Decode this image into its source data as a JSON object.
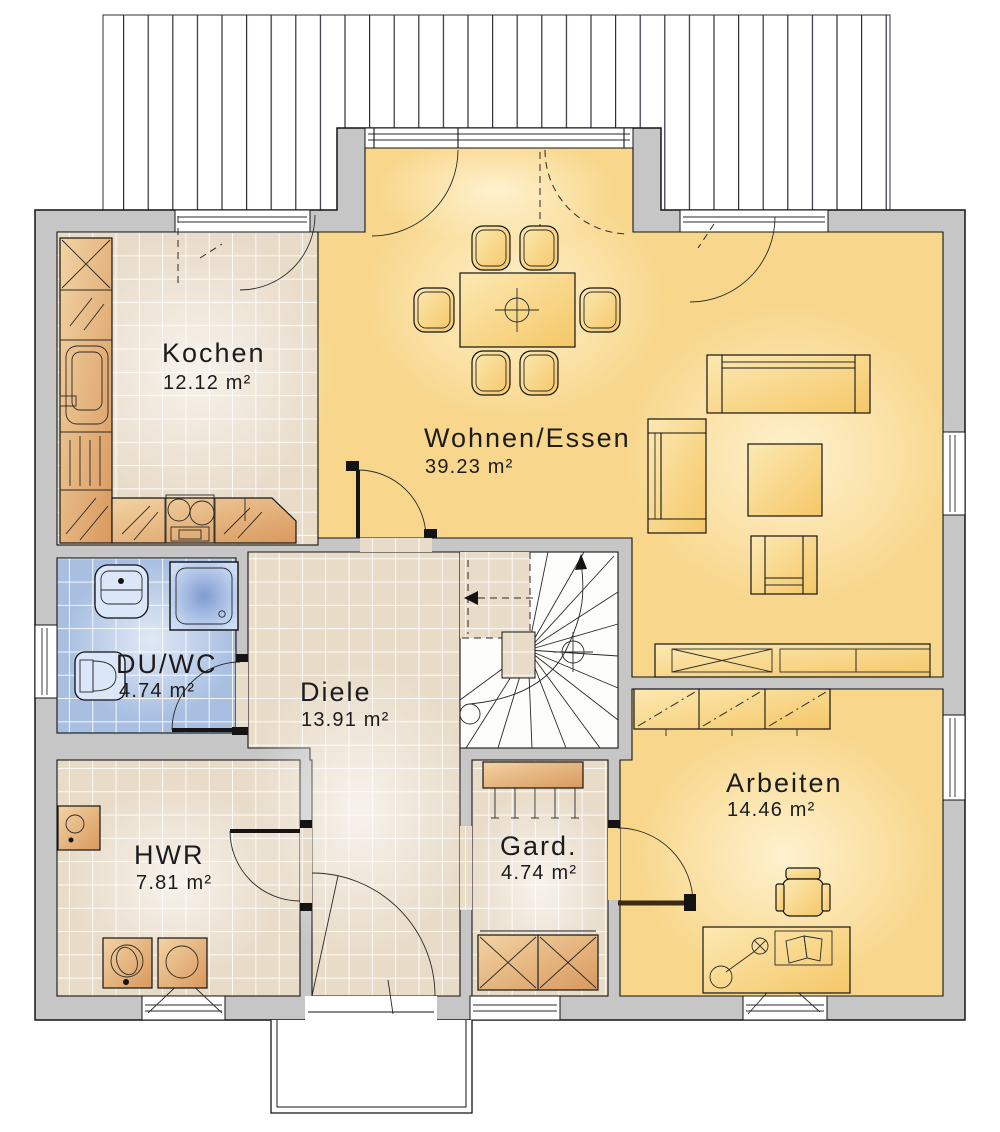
{
  "plan": {
    "rooms": [
      {
        "id": "kochen",
        "name": "Kochen",
        "area": "12.12 m²"
      },
      {
        "id": "wohnen-essen",
        "name": "Wohnen/Essen",
        "area": "39.23 m²"
      },
      {
        "id": "du-wc",
        "name": "DU/WC",
        "area": "4.74 m²"
      },
      {
        "id": "diele",
        "name": "Diele",
        "area": "13.91 m²"
      },
      {
        "id": "hwr",
        "name": "HWR",
        "area": "7.81 m²"
      },
      {
        "id": "gard",
        "name": "Gard.",
        "area": "4.74 m²"
      },
      {
        "id": "arbeiten",
        "name": "Arbeiten",
        "area": "14.46 m²"
      }
    ],
    "colors": {
      "wall": "#c6c6c6",
      "floor_living": "#f8d78c",
      "floor_tile": "#e8dbc8",
      "floor_bath": "#a8bfe2",
      "furniture_wood": "#e0a96f",
      "outline": "#141414"
    }
  }
}
